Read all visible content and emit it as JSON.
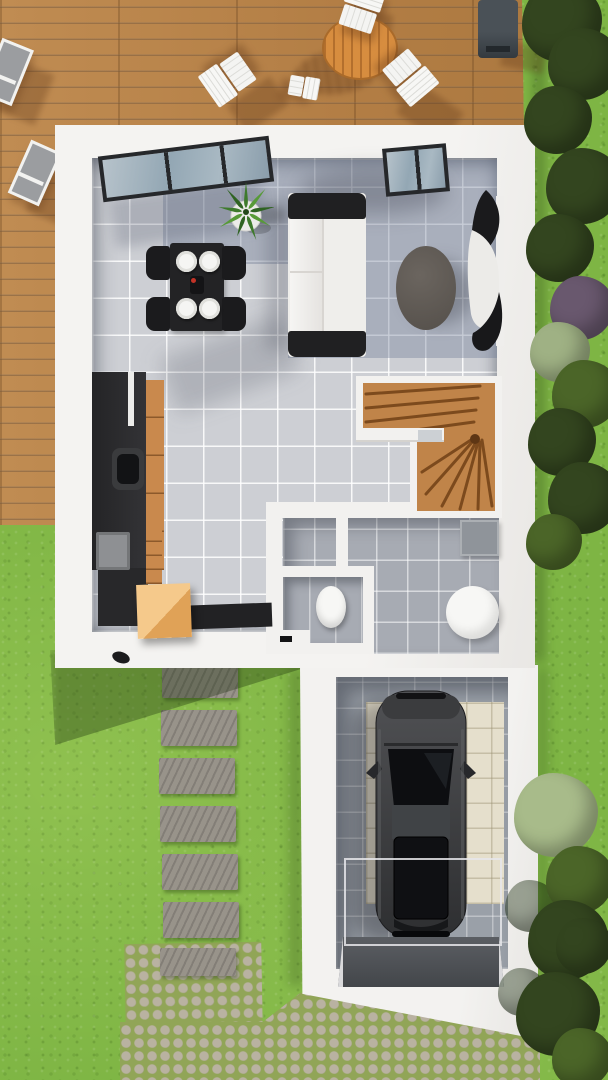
{
  "meta": {
    "kind": "3d-floor-plan-render-top-view",
    "canvas": {
      "width": 608,
      "height": 1080
    },
    "rooms": [
      "terrace-deck",
      "living-dining-room",
      "kitchen",
      "hallway",
      "wc",
      "bathroom",
      "winder-staircase",
      "garage",
      "garden",
      "cobbled-driveway"
    ],
    "objects": [
      "sun-loungers",
      "round-wood-table",
      "folding-deck-chairs",
      "barbecue-grill",
      "potted-plant",
      "dining-table-with-plates",
      "dining-chairs",
      "white-sofa",
      "oval-coffee-table",
      "curved-tv-sideboard",
      "kitchen-counter-with-sink",
      "wood-cabinets",
      "storage-crate",
      "doormat",
      "toilet",
      "shower-tray",
      "vanity",
      "car-top-view",
      "stepping-stones",
      "hedge",
      "trees"
    ]
  },
  "palette": {
    "grass": "#7eb544",
    "deck": "#b9854b",
    "house": "#f2f1ef",
    "tile": "#cdcfd4",
    "rug": "rgba(104,118,146,0.36)",
    "bath-tile": "#a7abb3",
    "garage-tile": "#9aa0a8",
    "pad": "#e5dfcc",
    "cobble-base": "#91a557",
    "cobble-stone": "#b9b2a1",
    "paver": "#98938a",
    "stair-wood": "#c08449",
    "tread": "#7c4a1d",
    "kitchen-wood": "#c9894d",
    "crate": "#e0a257",
    "crate-light": "#f5c98b",
    "ink": "#202022",
    "sofa-white": "#efeeeb",
    "table-dark": "#232325",
    "coffee": "#5c5651",
    "car": "#3e3f41",
    "glass": "#101114",
    "porcelain": "#f7f7f5",
    "hedge-dark": "#33451f",
    "hedge-mid": "#4b6528",
    "hedge-light": "#9fb184",
    "hedge-purple": "#69586e",
    "tree-light": "#a8bb8a",
    "out-table": "#d78d3f",
    "lounger": "#9b9da0",
    "shade": "rgba(25,45,12,0.40)",
    "shadow": "rgba(25,45,12,0.35)"
  },
  "instances": {
    "paver": [
      {
        "x": 162,
        "y": 662
      },
      {
        "x": 161,
        "y": 710
      },
      {
        "x": 159,
        "y": 758
      },
      {
        "x": 160,
        "y": 806
      },
      {
        "x": 162,
        "y": 854
      },
      {
        "x": 163,
        "y": 902
      },
      {
        "x": 160,
        "y": 948,
        "h": 28
      }
    ],
    "deck-chair": [
      {
        "x": 338,
        "y": -16,
        "rot": 18,
        "w": 46,
        "h": 50
      },
      {
        "x": 386,
        "y": 50,
        "rot": 140,
        "w": 46,
        "h": 52
      },
      {
        "x": 206,
        "y": 52,
        "rot": -125,
        "w": 46,
        "h": 52
      },
      {
        "x": 290,
        "y": 70,
        "rot": 100,
        "w": 26,
        "h": 34
      }
    ],
    "lounger": [
      {
        "x": -10,
        "y": 42,
        "rot": 22,
        "w": 34,
        "h": 60
      },
      {
        "x": 18,
        "y": 144,
        "rot": 24,
        "w": 34,
        "h": 58
      }
    ],
    "plate": [
      {
        "x": 176,
        "y": 251
      },
      {
        "x": 199,
        "y": 251
      },
      {
        "x": 176,
        "y": 298
      },
      {
        "x": 199,
        "y": 298
      }
    ],
    "hedge-blob": [
      {
        "x": 522,
        "y": -18,
        "r": 40,
        "c": "hedge-dark"
      },
      {
        "x": 548,
        "y": 28,
        "r": 36,
        "c": "hedge-dark"
      },
      {
        "x": 524,
        "y": 86,
        "r": 34,
        "c": "hedge-dark"
      },
      {
        "x": 546,
        "y": 148,
        "r": 38,
        "c": "hedge-dark"
      },
      {
        "x": 526,
        "y": 214,
        "r": 34,
        "c": "hedge-dark"
      },
      {
        "x": 550,
        "y": 276,
        "r": 32,
        "c": "hedge-purple"
      },
      {
        "x": 530,
        "y": 322,
        "r": 30,
        "c": "hedge-light"
      },
      {
        "x": 552,
        "y": 360,
        "r": 34,
        "c": "hedge-mid"
      },
      {
        "x": 528,
        "y": 408,
        "r": 34,
        "c": "hedge-dark"
      },
      {
        "x": 548,
        "y": 462,
        "r": 36,
        "c": "hedge-dark"
      },
      {
        "x": 526,
        "y": 514,
        "r": 28,
        "c": "hedge-mid"
      }
    ],
    "tree-blob": [
      {
        "x": 505,
        "y": 880,
        "r": 26,
        "c": "shade"
      },
      {
        "x": 498,
        "y": 968,
        "r": 24,
        "c": "shade"
      },
      {
        "x": 514,
        "y": 773,
        "r": 42,
        "c": "tree-light"
      },
      {
        "x": 546,
        "y": 846,
        "r": 34,
        "c": "hedge-mid"
      },
      {
        "x": 528,
        "y": 900,
        "r": 40,
        "c": "hedge-dark"
      },
      {
        "x": 516,
        "y": 972,
        "r": 42,
        "c": "hedge-dark"
      },
      {
        "x": 552,
        "y": 1028,
        "r": 30,
        "c": "hedge-mid"
      },
      {
        "x": 556,
        "y": 918,
        "r": 28,
        "c": "hedge-dark"
      }
    ]
  }
}
